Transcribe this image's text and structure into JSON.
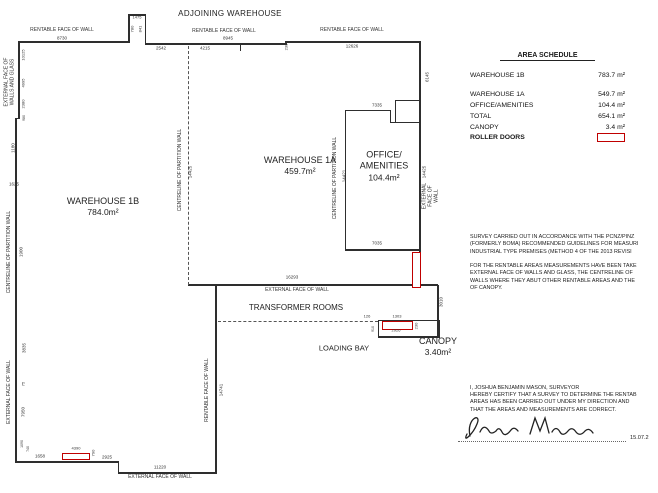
{
  "plan": {
    "adjoining_label": "ADJOINING WAREHOUSE",
    "rooms": {
      "warehouse_1b": {
        "name": "WAREHOUSE 1B",
        "area": "784.0m²"
      },
      "warehouse_1a": {
        "name": "WAREHOUSE 1A",
        "area": "459.7m²"
      },
      "office": {
        "line1": "OFFICE/",
        "line2": "AMENITIES",
        "area": "104.4m²"
      },
      "transformer": {
        "name": "TRANSFORMER ROOMS"
      },
      "loading_bay": {
        "name": "LOADING BAY"
      },
      "canopy": {
        "name": "CANOPY",
        "area": "3.40m²"
      }
    },
    "dim_labels": [
      {
        "t": "RENTABLE FACE OF WALL",
        "x": 62,
        "y": 31
      },
      {
        "t": "8730",
        "x": 62,
        "y": 38,
        "s": 4.5
      },
      {
        "t": "1475",
        "x": 137,
        "y": 18,
        "s": 4
      },
      {
        "t": "780",
        "x": 133,
        "y": 29,
        "r": 1,
        "s": 4
      },
      {
        "t": "841",
        "x": 141,
        "y": 29,
        "r": 1,
        "s": 4
      },
      {
        "t": "2542",
        "x": 161,
        "y": 48,
        "s": 4.5
      },
      {
        "t": "4215",
        "x": 205,
        "y": 48,
        "s": 4.5
      },
      {
        "t": "RENTABLE FACE OF WALL",
        "x": 224,
        "y": 32
      },
      {
        "t": "8945",
        "x": 228,
        "y": 38,
        "s": 4.5
      },
      {
        "t": "230",
        "x": 287,
        "y": 47,
        "r": 1,
        "s": 4
      },
      {
        "t": "RENTABLE FACE OF WALL",
        "x": 352,
        "y": 31
      },
      {
        "t": "12626",
        "x": 352,
        "y": 46,
        "s": 4.5
      },
      {
        "t": "6145",
        "x": 427,
        "y": 77,
        "r": 1,
        "s": 4.5
      },
      {
        "t": "EXTERNAL FACE OF\nWALLS AND GLASS",
        "x": 10,
        "y": 82,
        "r": 1
      },
      {
        "t": "10125",
        "x": 24,
        "y": 55,
        "r": 1,
        "s": 4
      },
      {
        "t": "4995",
        "x": 24,
        "y": 83,
        "r": 1,
        "s": 4
      },
      {
        "t": "2380",
        "x": 24,
        "y": 104,
        "r": 1,
        "s": 4
      },
      {
        "t": "980",
        "x": 24,
        "y": 118,
        "r": 1,
        "s": 3.5
      },
      {
        "t": "1180",
        "x": 13,
        "y": 148,
        "r": 1,
        "s": 4.5
      },
      {
        "t": "1625",
        "x": 14,
        "y": 184,
        "s": 4.5
      },
      {
        "t": "CENTRELINE OF PARTITION WALL",
        "x": 10,
        "y": 252,
        "r": 1
      },
      {
        "t": "1900",
        "x": 21,
        "y": 252,
        "r": 1,
        "s": 4.5
      },
      {
        "t": "3835",
        "x": 24,
        "y": 348,
        "r": 1,
        "s": 4.5
      },
      {
        "t": "75",
        "x": 24,
        "y": 384,
        "r": 1,
        "s": 4
      },
      {
        "t": "7950",
        "x": 23,
        "y": 412,
        "r": 1,
        "s": 4.5
      },
      {
        "t": "EXTERNAL FACE OF WALL",
        "x": 10,
        "y": 392,
        "r": 1
      },
      {
        "t": "1090",
        "x": 22,
        "y": 444,
        "r": 1,
        "s": 3.5
      },
      {
        "t": "740",
        "x": 28,
        "y": 449,
        "r": 1,
        "s": 3.5
      },
      {
        "t": "1658",
        "x": 40,
        "y": 456,
        "s": 4.5
      },
      {
        "t": "4390",
        "x": 76,
        "y": 449,
        "s": 4
      },
      {
        "t": "790",
        "x": 94,
        "y": 453,
        "r": 1,
        "s": 4
      },
      {
        "t": "2925",
        "x": 107,
        "y": 457,
        "s": 4.5
      },
      {
        "t": "11220",
        "x": 160,
        "y": 467,
        "s": 4.5
      },
      {
        "t": "EXTERNAL FACE OF WALL",
        "x": 160,
        "y": 478
      },
      {
        "t": "CENTRELINE OF PARTITION WALL",
        "x": 181,
        "y": 170,
        "r": 1
      },
      {
        "t": "14425",
        "x": 190,
        "y": 172,
        "r": 1,
        "s": 4.5
      },
      {
        "t": "RENTABLE FACE OF WALL",
        "x": 208,
        "y": 390,
        "r": 1
      },
      {
        "t": "14741",
        "x": 221,
        "y": 390,
        "r": 1,
        "s": 4.5
      },
      {
        "t": "7335",
        "x": 377,
        "y": 105,
        "s": 4.5
      },
      {
        "t": "CENTRELINE OF PARTITION WALL",
        "x": 336,
        "y": 178,
        "r": 1
      },
      {
        "t": "14421",
        "x": 344,
        "y": 176,
        "r": 1,
        "s": 4.5
      },
      {
        "t": "7035",
        "x": 377,
        "y": 243,
        "s": 4.5
      },
      {
        "t": "14425",
        "x": 424,
        "y": 172,
        "r": 1,
        "s": 4.5
      },
      {
        "t": "EXTERNAL FACE OF WALL",
        "x": 431,
        "y": 196,
        "r": 1
      },
      {
        "t": "16293",
        "x": 292,
        "y": 277,
        "s": 4.5
      },
      {
        "t": "EXTERNAL FACE OF WALL",
        "x": 297,
        "y": 291
      },
      {
        "t": "126",
        "x": 367,
        "y": 317,
        "s": 4
      },
      {
        "t": "1303",
        "x": 397,
        "y": 317,
        "s": 4
      },
      {
        "t": "2926",
        "x": 396,
        "y": 331,
        "s": 4
      },
      {
        "t": "230",
        "x": 417,
        "y": 326,
        "r": 1,
        "s": 4
      },
      {
        "t": "910",
        "x": 373,
        "y": 329,
        "r": 1,
        "s": 3.5
      },
      {
        "t": "3010",
        "x": 441,
        "y": 302,
        "r": 1,
        "s": 4.5
      }
    ]
  },
  "schedule": {
    "title": "AREA SCHEDULE",
    "rows": [
      {
        "label": "WAREHOUSE 1B",
        "value": "783.7 m²",
        "y": 72
      },
      {
        "label": "WAREHOUSE 1A",
        "value": "549.7 m²",
        "y": 91
      },
      {
        "label": "OFFICE/AMENITIES",
        "value": "104.4 m²",
        "y": 102
      },
      {
        "label": "TOTAL",
        "value": "654.1 m²",
        "y": 113
      },
      {
        "label": "CANOPY",
        "value": "3.4 m²",
        "y": 124
      }
    ],
    "roller_doors_label": "ROLLER DOORS",
    "roller_door_color": "#c00000"
  },
  "notes": {
    "lines": [
      "SURVEY CARRIED OUT IN ACCORDANCE WITH THE PCNZ/PINZ",
      "(FORMERLY BOMA) RECOMMENDED GUIDELINES FOR MEASURI",
      "INDUSTRIAL TYPE PREMISES (METHOD 4 OF THE 2013 REVISI",
      "",
      "FOR THE RENTABLE AREAS MEASUREMENTS HAVE BEEN TAKE",
      "EXTERNAL FACE OF WALLS AND GLASS, THE CENTRELINE OF",
      "WALLS WHERE THEY ABUT OTHER RENTABLE AREAS AND THE",
      "OF CANOPY."
    ]
  },
  "certification": {
    "lines": [
      "I, JOSHUA BENJAMIN MASON, SURVEYOR",
      "HEREBY CERTIFY THAT A SURVEY TO DETERMINE THE RENTAB",
      "AREAS HAS BEEN CARRIED OUT UNDER MY DIRECTION AND",
      "THAT THE AREAS AND MEASUREMENTS ARE CORRECT."
    ],
    "signature_name": "Joshua Mason",
    "date": "15.07.2"
  }
}
